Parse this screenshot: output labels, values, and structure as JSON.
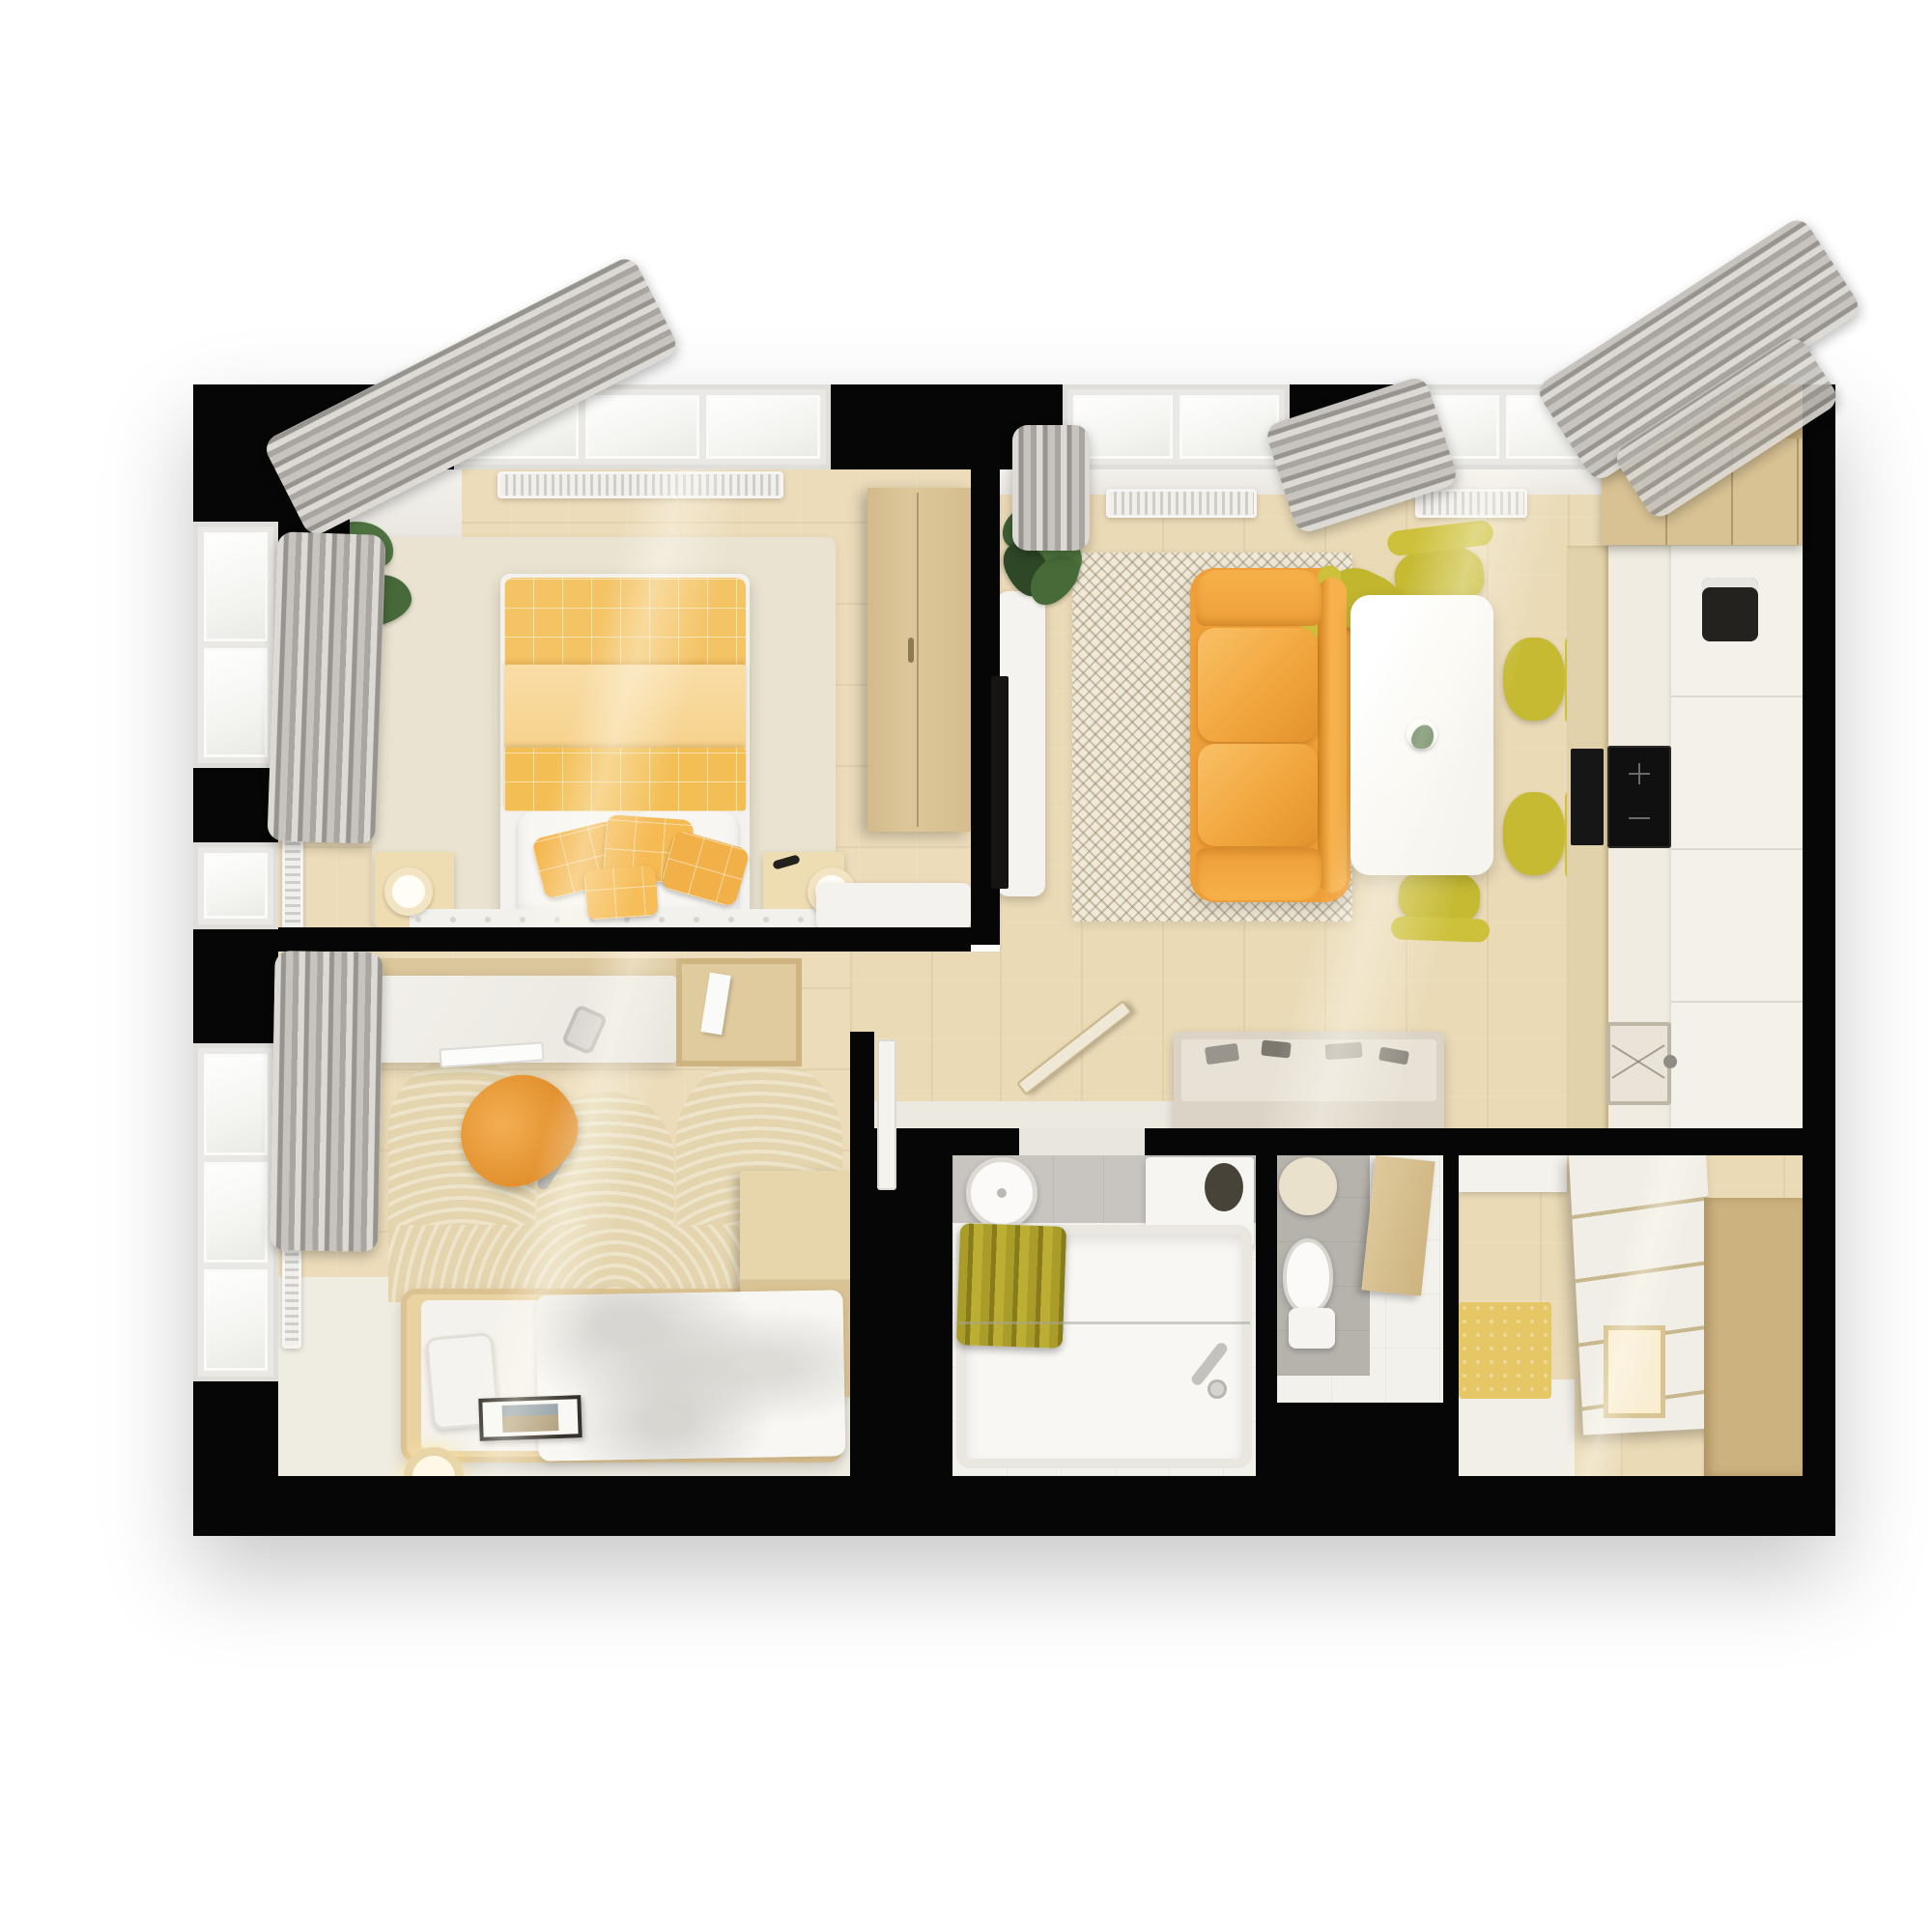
{
  "scene": {
    "title": "3D top-view floor plan of a one-bedroom apartment",
    "background": "#ffffff",
    "wall_color": "#060606"
  },
  "palette": {
    "wood_floor": "#ecdcba",
    "cream_rug": "#eae3d1",
    "herringbone_rug": "#efe9d9",
    "accent_yellow": "#f2b54b",
    "duvet_yellow": "#f4c364",
    "sofa_orange": "#ef9f38",
    "chair_mustard": "#c6ba33",
    "cabinet_tan": "#dac395",
    "curtain_gray": "#aaa7a2",
    "tile_gray": "#c8c5c0",
    "towel_olive": "#a99c28",
    "white_furniture": "#f4f2ed"
  },
  "rooms": {
    "bedroom": {
      "name": "Bedroom"
    },
    "living": {
      "name": "Living room with kitchen"
    },
    "study": {
      "name": "Second bedroom"
    },
    "hallway": {
      "name": "Hallway"
    },
    "bathroom": {
      "name": "Bathroom"
    },
    "wc": {
      "name": "WC"
    },
    "entry": {
      "name": "Entry storage"
    }
  },
  "furniture": {
    "bedroom": [
      "double bed with yellow duvet",
      "white pillows",
      "yellow accent pillows",
      "tufted bench",
      "two nightstands with lamps",
      "tall wardrobe",
      "white console",
      "potted plant",
      "rug"
    ],
    "living": [
      "yellow sofa",
      "white dining table",
      "mustard dining chairs",
      "tv console with tv",
      "herringbone rug",
      "plant",
      "shoe bench",
      "kitchen cabinets",
      "cooktop and oven",
      "sink",
      "coffee machine"
    ],
    "study": [
      "desk with keyboard and mug",
      "orange desk chair",
      "shelf unit",
      "single bed",
      "scalloped rug",
      "floor lamp",
      "picture frame",
      "corner cabinet"
    ],
    "bathroom": [
      "round sink",
      "mirror cabinet",
      "bathtub",
      "olive towels",
      "faucet"
    ],
    "wc": [
      "toilet",
      "round mirror",
      "gray tiled wall"
    ],
    "entry": [
      "drawer wardrobe",
      "yellow mat",
      "lit niche"
    ]
  }
}
